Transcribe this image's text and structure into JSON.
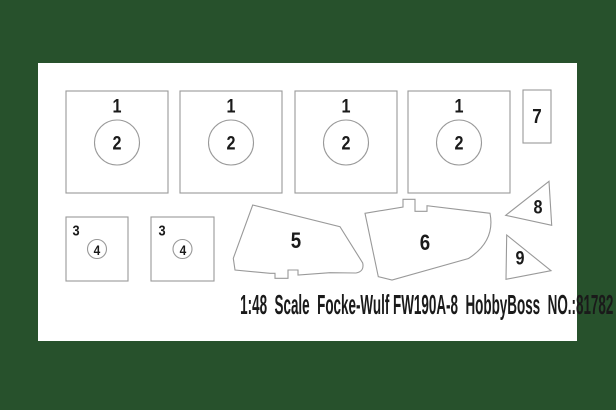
{
  "caption": "1:48  Scale  Focke-Wulf FW190A-8  HobbyBoss  NO.:81782",
  "colors": {
    "background": "#27512c",
    "panel": "#ffffff",
    "cutline": "#999999",
    "ink": "#1a1a1a"
  },
  "parts": {
    "big_square": "1",
    "big_circle": "2",
    "small_square": "3",
    "small_circle": "4",
    "canopy_left": "5",
    "canopy_right": "6",
    "strip": "7",
    "triangle_upper": "8",
    "triangle_lower": "9"
  }
}
